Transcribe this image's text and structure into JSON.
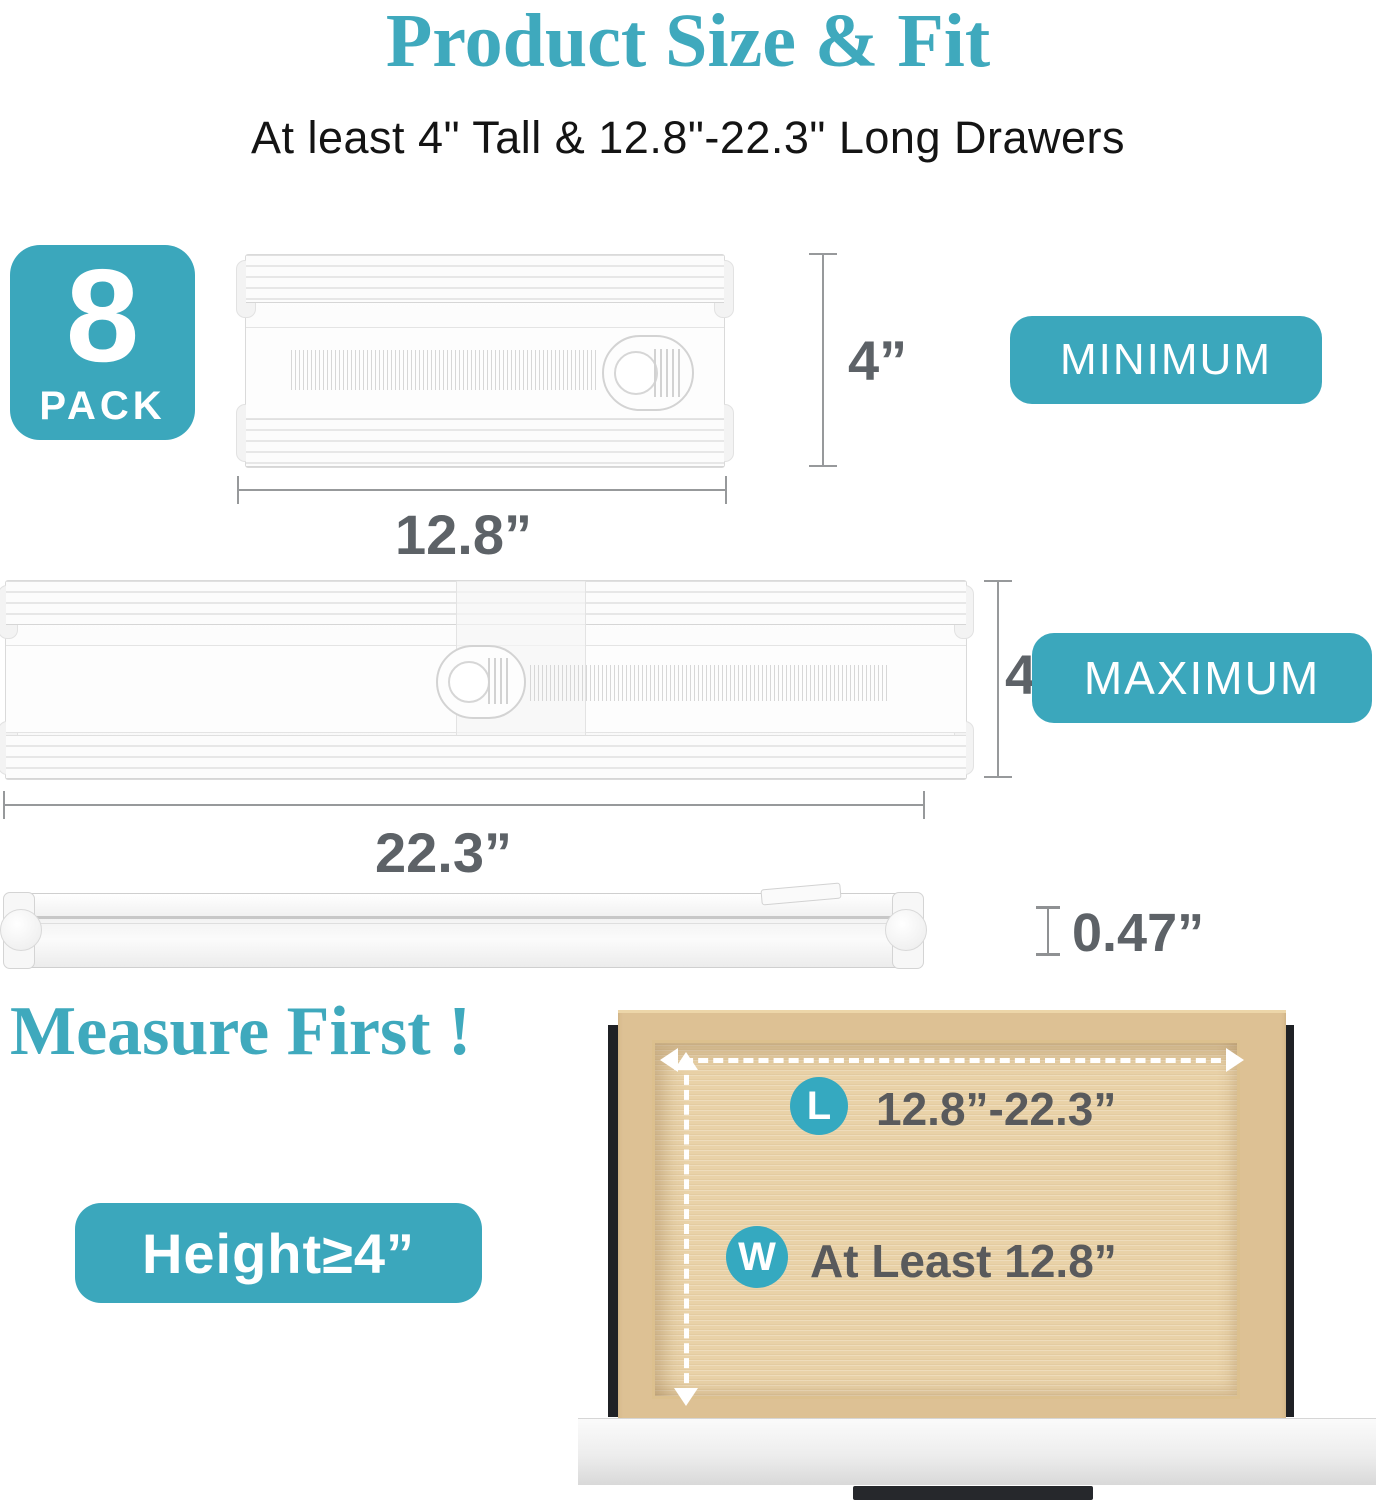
{
  "colors": {
    "teal": "#3BA7BC",
    "title_teal": "#3FA9BD",
    "dimension_text": "#5D6267",
    "dimension_line": "#97999B",
    "wood": "#DDC194",
    "wood_panel": "#E9D2A8",
    "handle": "#26282C"
  },
  "header": {
    "title": "Product Size & Fit",
    "subtitle": "At least 4\" Tall & 12.8\"-22.3\" Long Drawers"
  },
  "pack_badge": {
    "number": "8",
    "label": "PACK"
  },
  "minimum": {
    "badge": "MINIMUM",
    "height_label": "4”",
    "width_label": "12.8”"
  },
  "maximum": {
    "badge": "MAXIMUM",
    "height_label": "4''",
    "width_label": "22.3”"
  },
  "thickness": {
    "label": "0.47”"
  },
  "measure": {
    "heading": "Measure First !",
    "height_badge": "Height≥4”"
  },
  "drawer": {
    "length_marker": "L",
    "length_value": "12.8”-22.3”",
    "width_marker": "W",
    "width_value": "At Least 12.8”"
  }
}
